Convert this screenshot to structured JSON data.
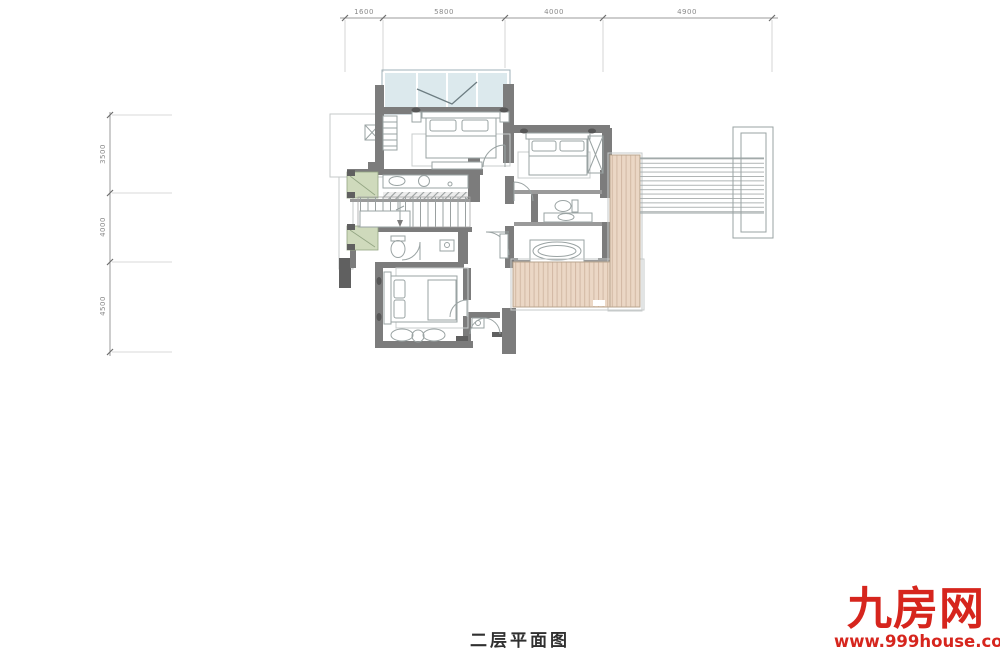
{
  "title": "二层平面图",
  "watermark": {
    "brand": "九房网",
    "url": "www.999house.com"
  },
  "dimensions": {
    "top": [
      "1600",
      "5800",
      "4000",
      "4900"
    ],
    "left": [
      "3500",
      "4000",
      "4500"
    ]
  },
  "colors": {
    "wall": "#7c7c7c",
    "wall_dark": "#606060",
    "fline": "#9aa3a3",
    "glazing": "#dce9ed",
    "glazing_frame": "#9fb2b8",
    "planter": "#cfdabc",
    "planter_line": "#93a583",
    "deck": "#ebd7c5",
    "deck_line": "#d2b9a4",
    "deck_border": "#b9a68f",
    "outline": "#c6caca",
    "dim": "#9b9b9b",
    "watermark": "#d6251d",
    "title_color": "#303030"
  }
}
